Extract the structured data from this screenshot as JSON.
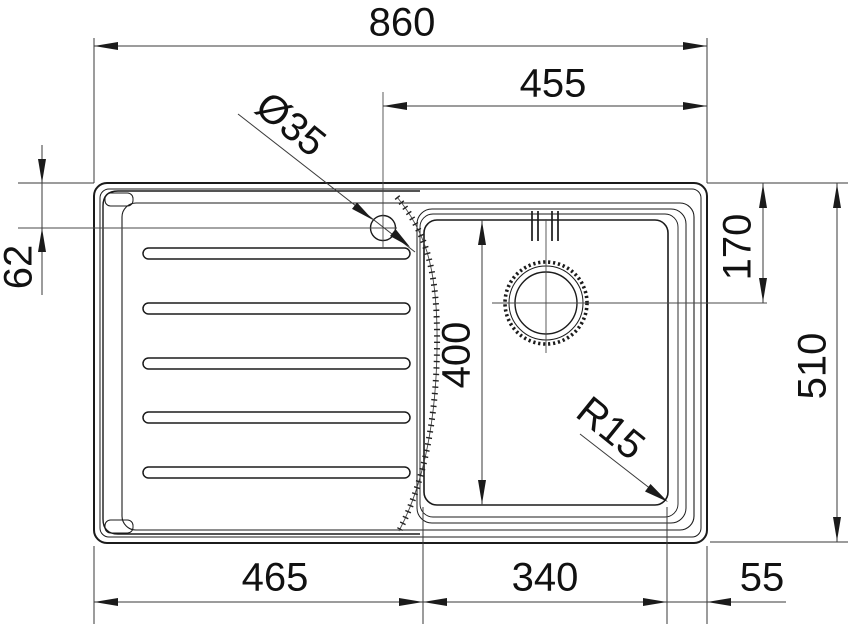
{
  "page": {
    "background": "#ffffff",
    "line_color": "#1b1b1b",
    "dim_color": "#3a3a3a"
  },
  "dimensions": {
    "overall_width": "860",
    "tap_center_to_right_edge": "455",
    "tap_hole_diameter": "Ø35",
    "tap_center_from_top_edge": "62",
    "drain_center_from_top_edge": "170",
    "overall_depth": "510",
    "bowl_inner_depth": "400",
    "bowl_corner_radius": "R15",
    "left_edge_to_bowl": "465",
    "bowl_inner_width": "340",
    "bowl_to_right_edge": "55"
  }
}
